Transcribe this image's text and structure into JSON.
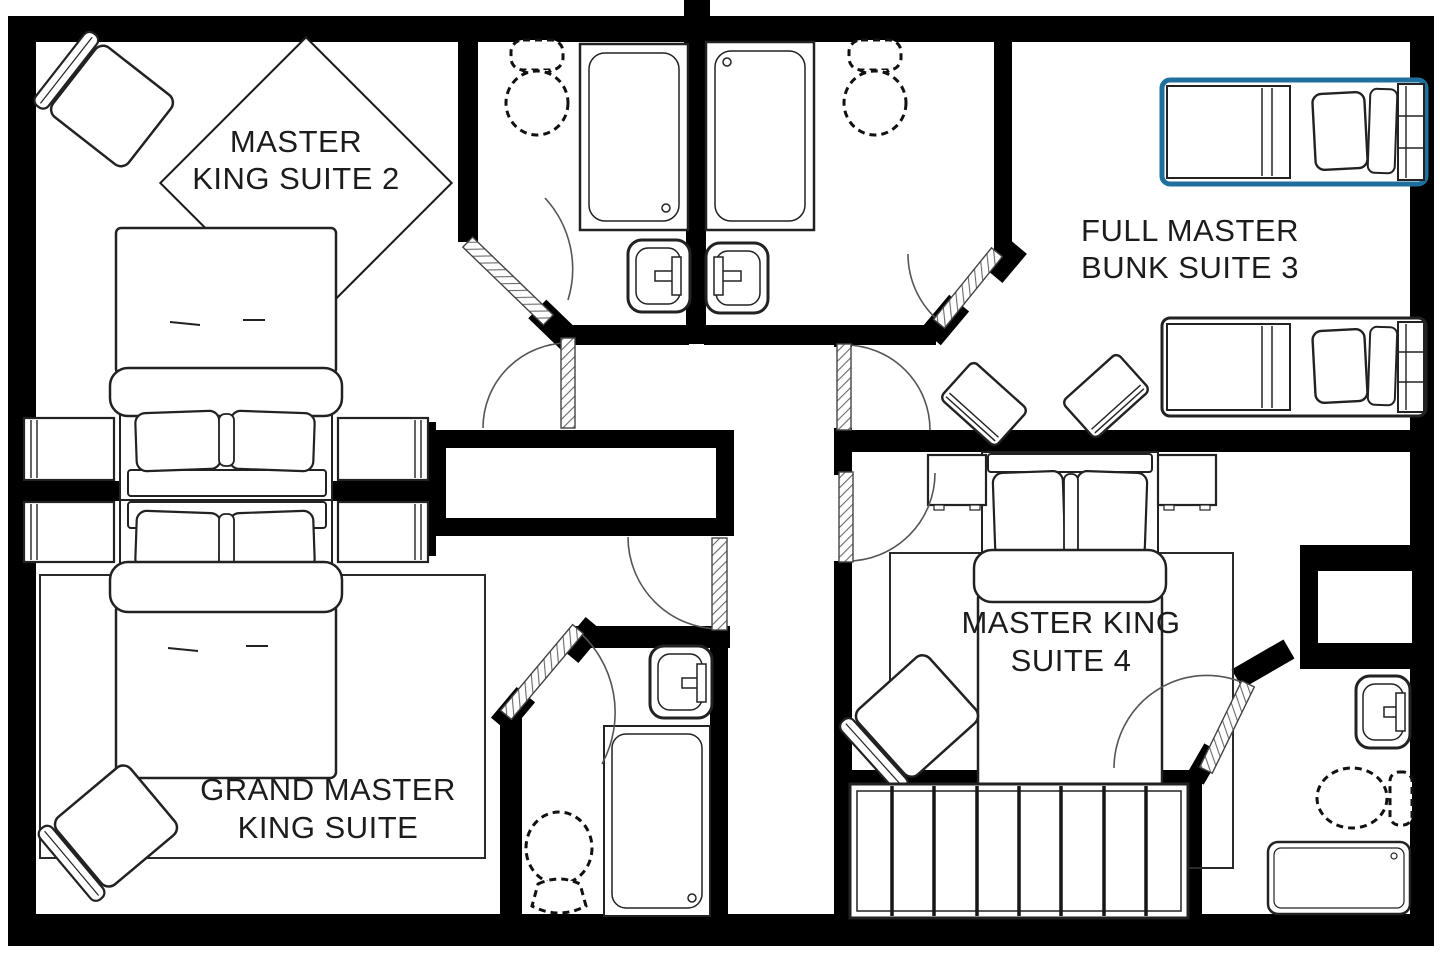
{
  "meta": {
    "type": "floor-plan",
    "description": "Second-floor vacation rental floor plan with four bedroom suites and four bathrooms",
    "colors": {
      "wall": "#000000",
      "ink": "#1c1c1c",
      "background": "#ffffff",
      "highlight": "#1f6f9f"
    },
    "highlight_applies_to": "top full bed in bunk suite 3"
  },
  "rooms": [
    {
      "id": "master-king-suite-2",
      "name": "Master King Suite 2",
      "lines": [
        "MASTER",
        "KING SUITE 2"
      ]
    },
    {
      "id": "full-master-bunk-suite-3",
      "name": "Full Master Bunk Suite 3",
      "lines": [
        "FULL MASTER",
        "BUNK SUITE 3"
      ]
    },
    {
      "id": "grand-master-king-suite",
      "name": "Grand Master King Suite",
      "lines": [
        "GRAND MASTER",
        "KING SUITE"
      ]
    },
    {
      "id": "master-king-suite-4",
      "name": "Master King Suite 4",
      "lines": [
        "MASTER KING",
        "SUITE 4"
      ]
    }
  ],
  "fixtures": {
    "master_king_suite_2": [
      "king-bed",
      "nightstand-left",
      "nightstand-right",
      "armchair",
      "diamond-label-rug"
    ],
    "bathroom_top_left": [
      "toilet",
      "shower",
      "sink",
      "swing-door"
    ],
    "bathroom_top_right": [
      "shower",
      "toilet",
      "sink",
      "swing-door"
    ],
    "full_master_bunk_suite_3": [
      "full-bed-highlighted",
      "full-bed",
      "bench",
      "bench",
      "swing-door"
    ],
    "grand_master_king_suite": [
      "king-bed",
      "nightstand-left",
      "nightstand-right",
      "armchair",
      "area-rug",
      "swing-door"
    ],
    "grand_master_bathroom": [
      "sink",
      "shower",
      "toilet",
      "swing-door"
    ],
    "master_king_suite_4": [
      "king-bed",
      "nightstand-left",
      "nightstand-right",
      "armchair",
      "area-rug",
      "swing-door"
    ],
    "suite_4_bathroom": [
      "wall-closet",
      "sink",
      "toilet",
      "bathtub",
      "swing-door"
    ],
    "hall": [
      "linen-closet",
      "slatted-wardrobe"
    ]
  }
}
